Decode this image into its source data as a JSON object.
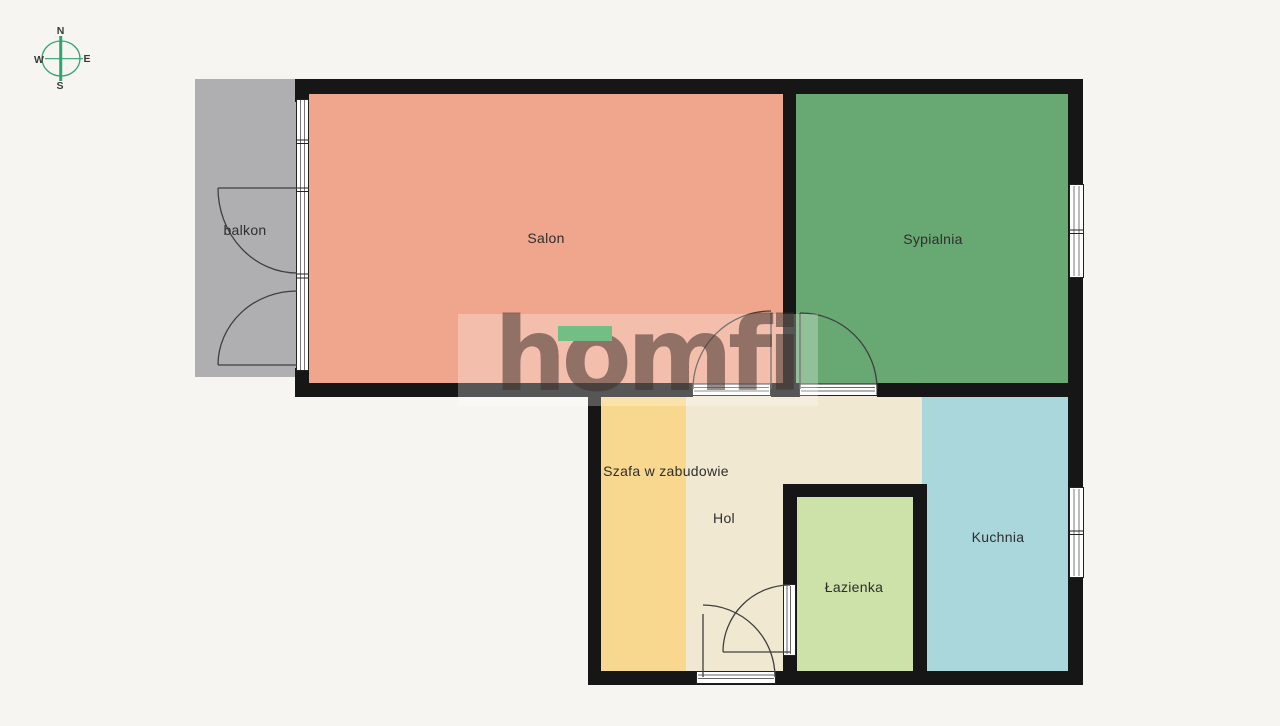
{
  "compass": {
    "north": "N",
    "east": "E",
    "south": "S",
    "west": "W"
  },
  "watermark": {
    "brand": "homfi",
    "accent_color": "#72BE84"
  },
  "rooms": {
    "balkon": {
      "label": "balkon",
      "color": "#AFAEB1"
    },
    "salon": {
      "label": "Salon",
      "color": "#EFA68D"
    },
    "sypialnia": {
      "label": "Sypialnia",
      "color": "#68A872"
    },
    "szafa": {
      "label": "Szafa w zabudowie",
      "color": "#F8D78E"
    },
    "hol": {
      "label": "Hol",
      "color": "#F1E8D1"
    },
    "lazienka": {
      "label": "Łazienka",
      "color": "#CCE2A8"
    },
    "kuchnia": {
      "label": "Kuchnia",
      "color": "#AAD7DC"
    }
  },
  "colors": {
    "background": "#F7F5F1",
    "wall": "#161616",
    "door_line": "#3F3F3F",
    "compass_green": "#2FA470"
  }
}
